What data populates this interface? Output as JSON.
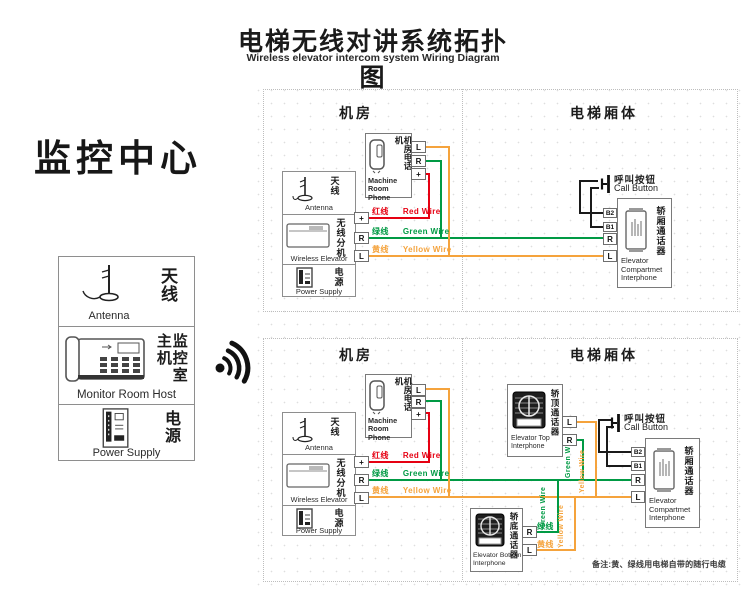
{
  "title": {
    "zh": "电梯无线对讲系统拓扑图",
    "en": "Wireless elevator intercom system Wiring Diagram"
  },
  "monitor": {
    "heading": "监控中心",
    "antenna": {
      "zh": "天线",
      "en": "Antenna"
    },
    "host": {
      "zh": "监控室主机",
      "en": "Monitor Room Host"
    },
    "power": {
      "zh": "电源",
      "en": "Power Supply"
    }
  },
  "section_labels": {
    "machine_room": "机房",
    "elevator_car": "电梯厢体"
  },
  "components": {
    "machine_room_phone": {
      "zh": "机房电话机",
      "en": "Machine Room Phone"
    },
    "antenna": {
      "zh": "天线",
      "en": "Antenna"
    },
    "wireless_extension": {
      "zh": "无线分机",
      "en": "Wireless Elevator"
    },
    "power_supply": {
      "zh": "电源",
      "en": "Power Supply"
    },
    "call_button": {
      "zh": "呼叫按钮",
      "en": "Call Button"
    },
    "compartment_interphone": {
      "zh": "轿厢通话器",
      "en": "Elevator Compartmet Interphone"
    },
    "top_interphone": {
      "zh": "轿顶通话器",
      "en": "Elevator Top Interphone"
    },
    "bottom_interphone": {
      "zh": "轿底通话器",
      "en": "Elevator Bottom Interphone"
    }
  },
  "terminals": {
    "plus": "+",
    "r": "R",
    "l": "L",
    "b1": "B1",
    "b2": "B2"
  },
  "wires": {
    "red": {
      "zh": "红线",
      "en": "Red Wire"
    },
    "green": {
      "zh": "绿线",
      "en": "Green Wire"
    },
    "yellow": {
      "zh": "黄线",
      "en": "Yellow Wire"
    }
  },
  "note": "备注:黄、绿线用电梯自带的随行电缆",
  "colors": {
    "red": "#e60012",
    "green": "#009a44",
    "yellow": "#f5a33c",
    "wire_black": "#1a1a1a",
    "box_border": "#8e8e8e",
    "dashed": "#bdbdbd"
  }
}
